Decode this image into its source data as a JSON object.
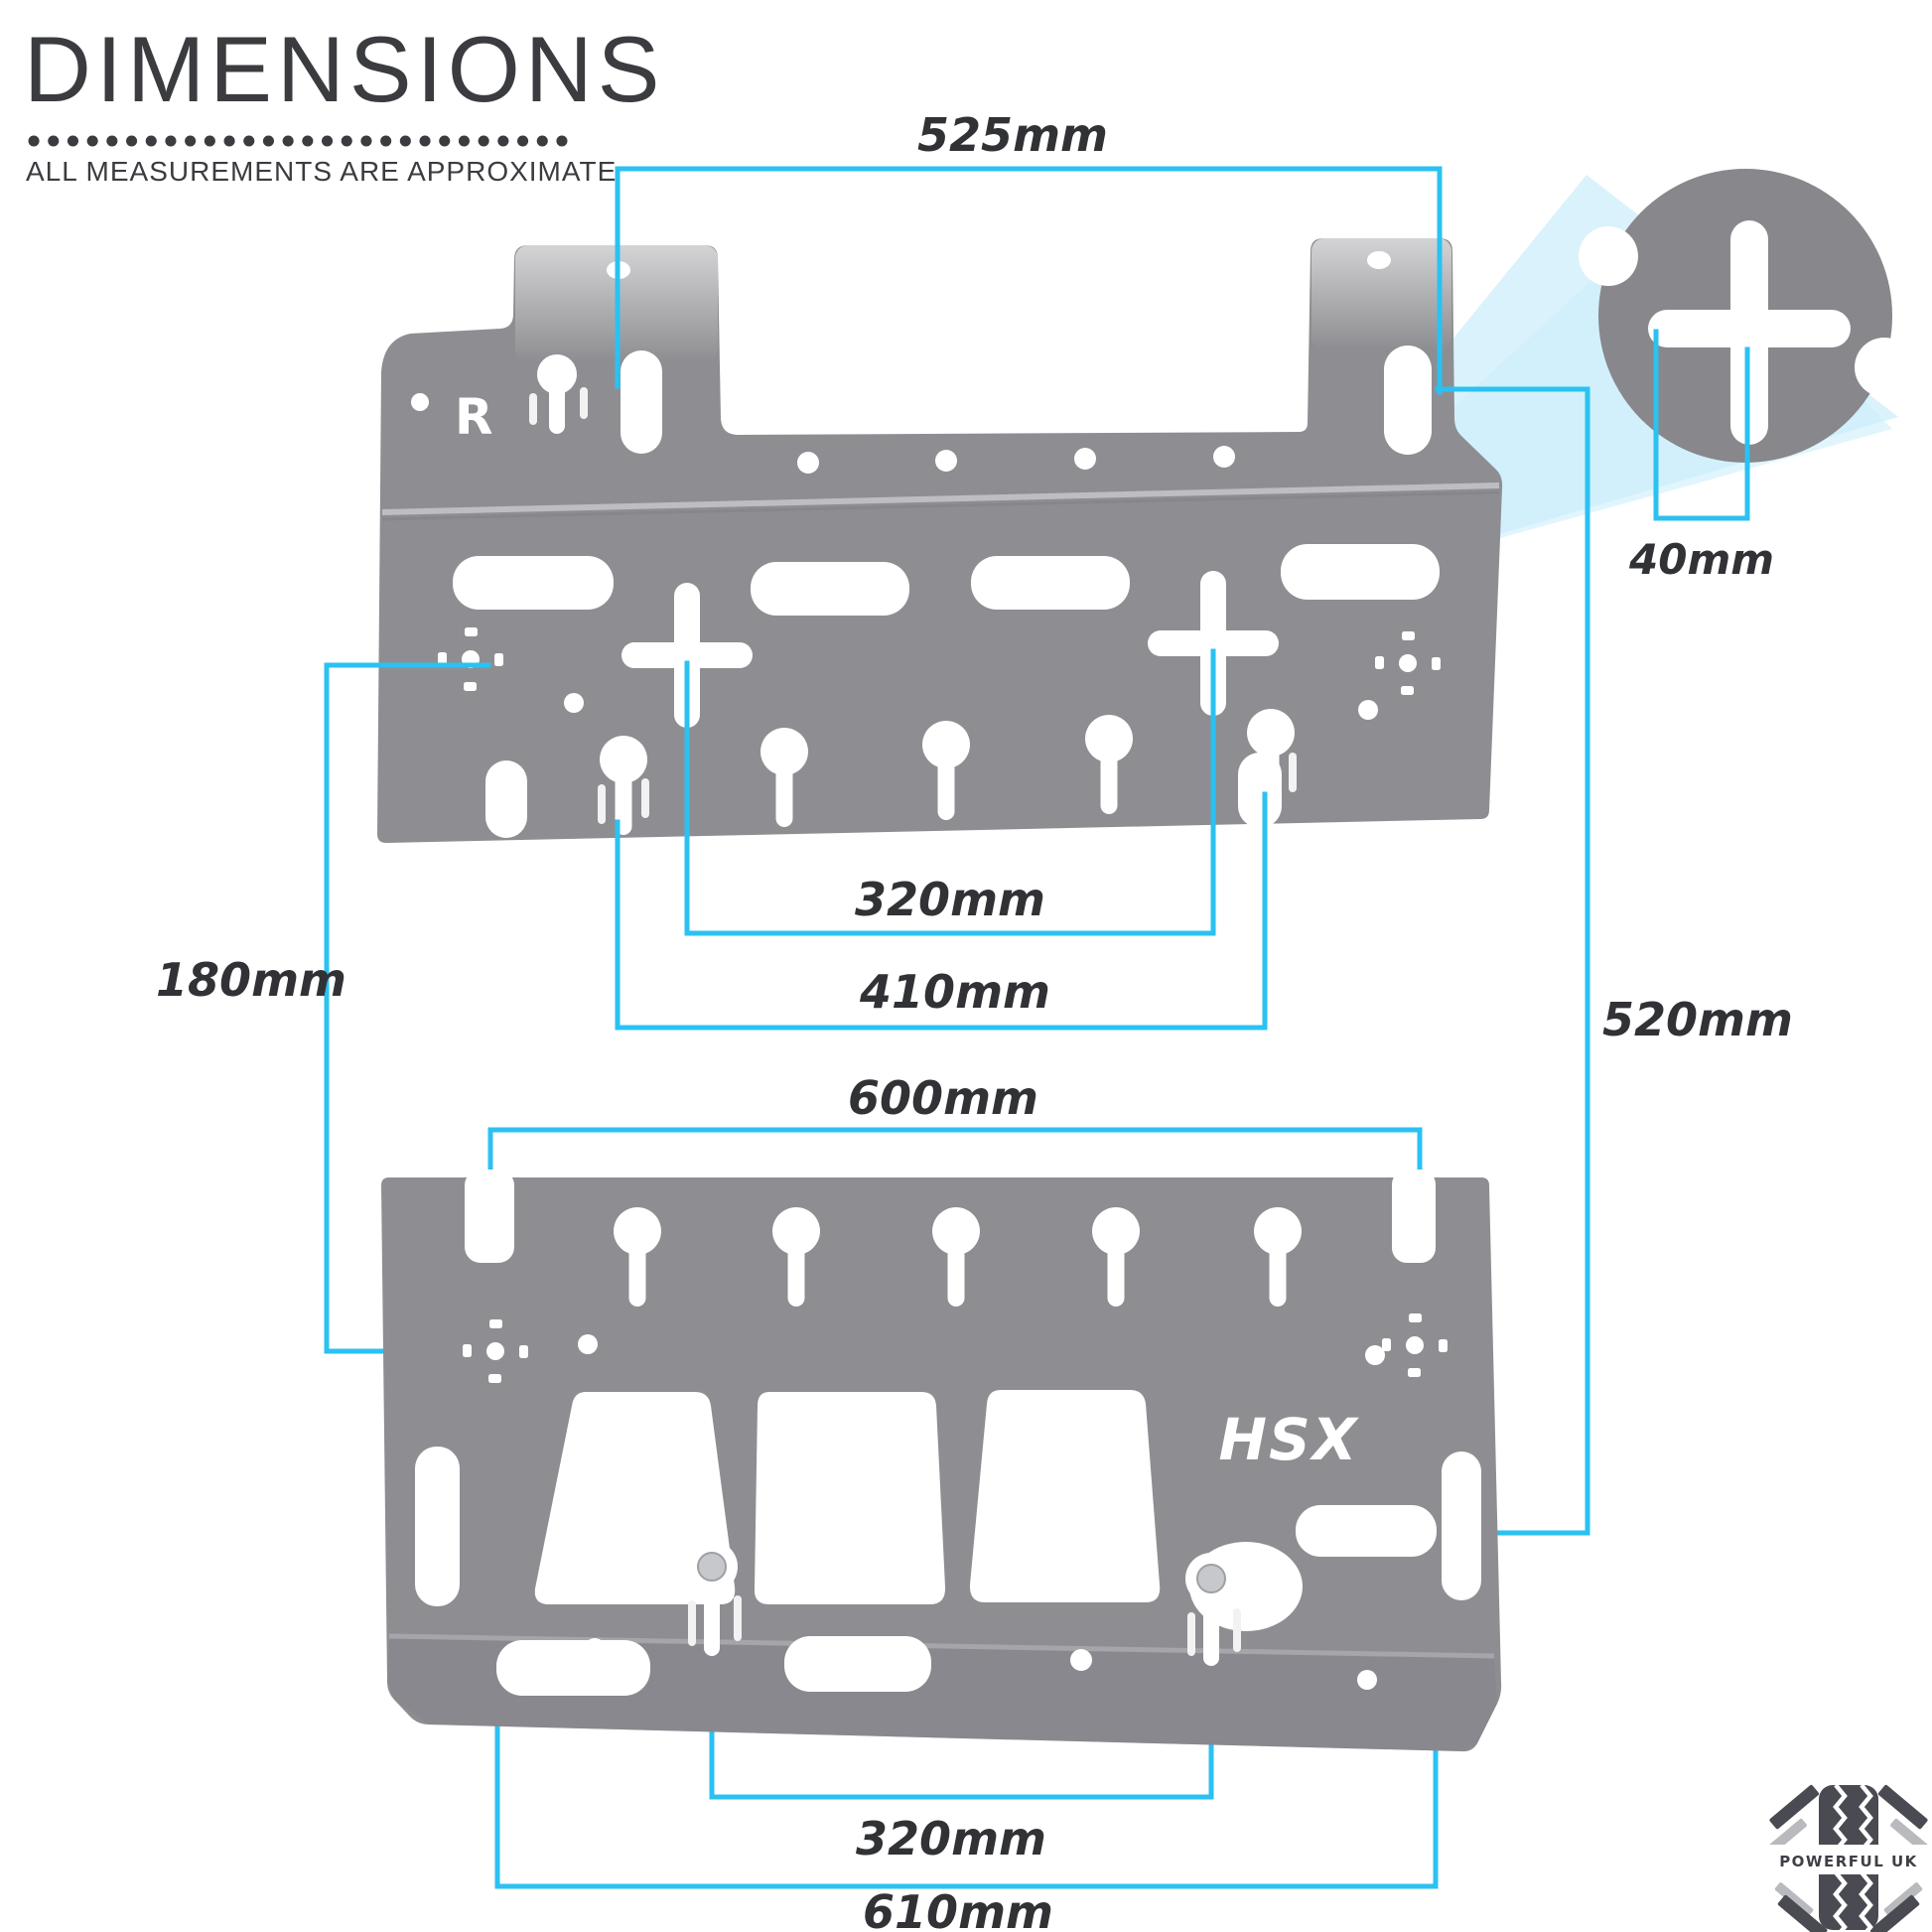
{
  "header": {
    "title": "DIMENSIONS",
    "subtitle": "ALL MEASUREMENTS ARE APPROXIMATE"
  },
  "dimensions": {
    "top_plate_slot_width": "525mm",
    "cross_detail_width": "40mm",
    "top_cross_spacing": "320mm",
    "top_keyhole_spacing": "410mm",
    "plate_vertical_gap": "180mm",
    "overall_height": "520mm",
    "bottom_slot_spacing": "600mm",
    "bottom_bolt_spacing": "320mm",
    "bottom_overall_width": "610mm"
  },
  "plate_marks": {
    "top_plate_logo": "R",
    "bottom_plate_logo": "HSX"
  },
  "branding": {
    "logo_text": "POWERFUL UK"
  },
  "colors": {
    "accent_cyan": "#2bc1f1",
    "plate_gray": "#8e8e92",
    "detail_gray": "#87878c",
    "label_dark": "#313236"
  }
}
